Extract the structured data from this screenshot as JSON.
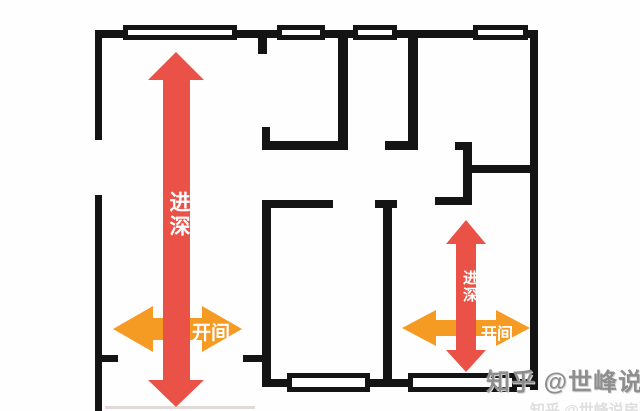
{
  "labels": {
    "left_depth": "进深",
    "left_bay": "开间",
    "right_depth": "进深",
    "right_bay": "开间"
  },
  "watermark": {
    "text": "知乎 @世峰说房",
    "ghost_text": "知乎 @世峰说房"
  },
  "colors": {
    "arrow_red": "#EA5147",
    "arrow_orange": "#F59A23",
    "wall": "#141414",
    "background": "#FEFEFE",
    "label_text": "#FFFFFF",
    "watermark": "#8E8E8E"
  }
}
